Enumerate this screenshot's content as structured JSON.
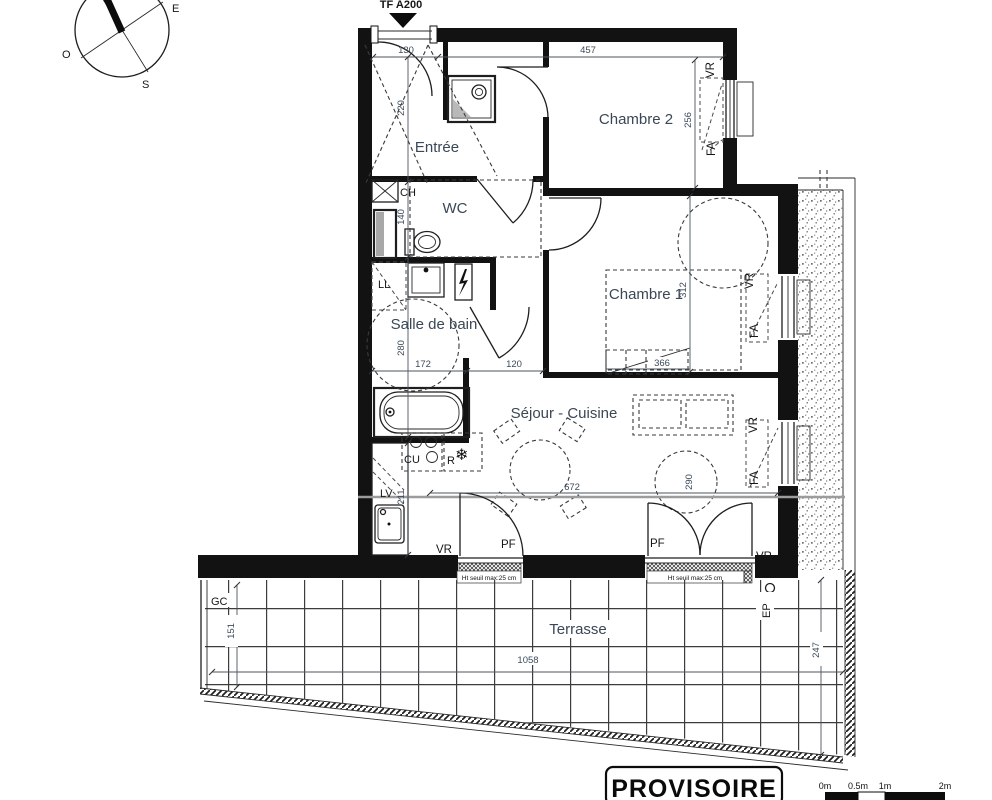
{
  "marker": {
    "ref": "TF A200"
  },
  "compass": {
    "west": "O",
    "south": "S",
    "east": "E"
  },
  "rooms": {
    "entree": "Entrée",
    "wc": "WC",
    "salle_de_bain": "Salle de bain",
    "chambre1": "Chambre 1",
    "chambre2": "Chambre 2",
    "sejour_cuisine": "Séjour - Cuisine",
    "terrasse": "Terrasse"
  },
  "dims": {
    "entree_width": "130",
    "entree_depth": "220",
    "wc_depth": "140",
    "chambre2_width": "457",
    "chambre2_depth": "256",
    "sdb_width": "172",
    "hall_width": "120",
    "sdb_depth": "280",
    "chambre1_depth": "312",
    "chambre1_width": "366",
    "sejour_width": "672",
    "sejour_circle": "290",
    "kitchen_depth": "211",
    "terrasse_left": "151",
    "terrasse_width": "1058",
    "terrasse_right": "247"
  },
  "equipment": {
    "water_heater": "CH",
    "washing_machine": "LL",
    "dishwasher": "LV",
    "cooktop": "CU",
    "fridge": "R",
    "snowflake_icon": "❄",
    "duct": "GC",
    "rain_pipe": "EP"
  },
  "openings": {
    "roller_shutter": "VR",
    "window": "FA",
    "french_window": "PF",
    "threshold_note": "Ht seuil max:25 cm"
  },
  "footer": {
    "stamp": "PROVISOIRE",
    "scale_labels": [
      "0m",
      "0.5m",
      "1m",
      "2m"
    ]
  }
}
